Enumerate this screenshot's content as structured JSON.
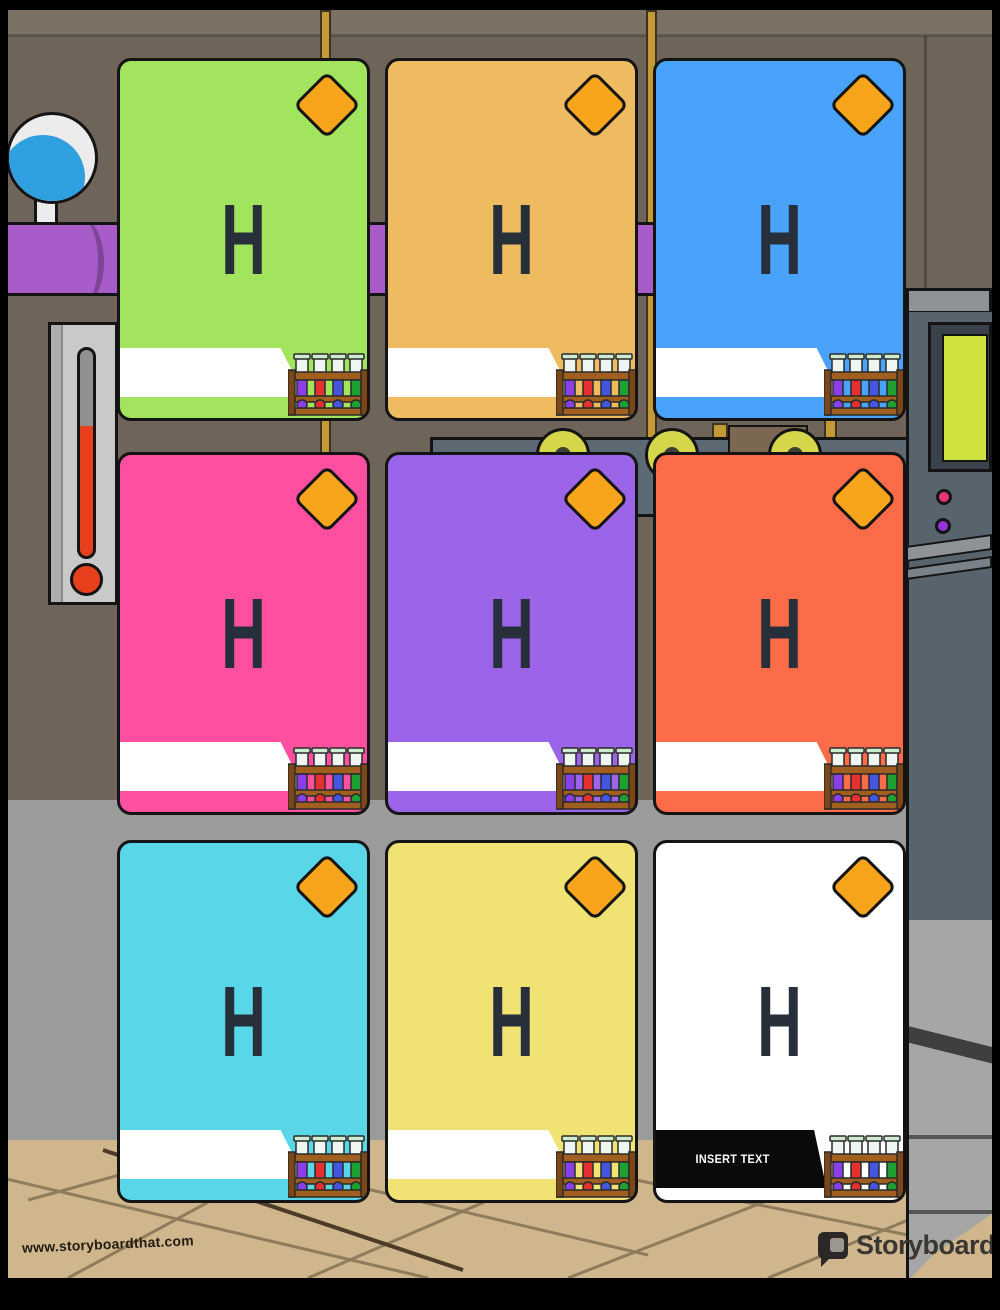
{
  "palette": {
    "wall": "#6f6459",
    "wall_light": "#7b7064",
    "mid_wall": "#9b9b9b",
    "floor_tan": "#cfb68c",
    "floor_line": "#8f7c5c",
    "pipe_gold": "#c49a37",
    "pipe_purple": "#a85cc9",
    "machine_panel": "#5d6a73",
    "machine_dark": "#57646e",
    "machine_light": "#8f9398",
    "machine_lower": "#a6a6a6",
    "screen_green": "#cfe23f",
    "gear_yellow": "#d6d64b",
    "dot_pink": "#e8357a",
    "dot_purple": "#9232d8",
    "flask_blue": "#2f9fe0",
    "thermo_red": "#e8401c",
    "diamond_orange": "#f9a51b",
    "letter_dark": "#272f3a",
    "card_border": "#141414"
  },
  "cards": [
    {
      "letter": "H",
      "color": "#a2e45e",
      "banner": "blank",
      "banner_text": ""
    },
    {
      "letter": "H",
      "color": "#eebb60",
      "banner": "blank",
      "banner_text": ""
    },
    {
      "letter": "H",
      "color": "#4aa3fa",
      "banner": "blank",
      "banner_text": ""
    },
    {
      "letter": "H",
      "color": "#ff4fa1",
      "banner": "blank",
      "banner_text": ""
    },
    {
      "letter": "H",
      "color": "#9c64e9",
      "banner": "blank",
      "banner_text": ""
    },
    {
      "letter": "H",
      "color": "#fd6c49",
      "banner": "blank",
      "banner_text": ""
    },
    {
      "letter": "H",
      "color": "#59d6e7",
      "banner": "blank",
      "banner_text": ""
    },
    {
      "letter": "H",
      "color": "#f0e273",
      "banner": "blank",
      "banner_text": ""
    },
    {
      "letter": "H",
      "color": "#ffffff",
      "banner": "placeholder",
      "banner_text": "INSERT TEXT"
    }
  ],
  "footer": {
    "url": "www.storyboardthat.com",
    "brand_primary": "Storyboard",
    "brand_secondary": "That"
  }
}
